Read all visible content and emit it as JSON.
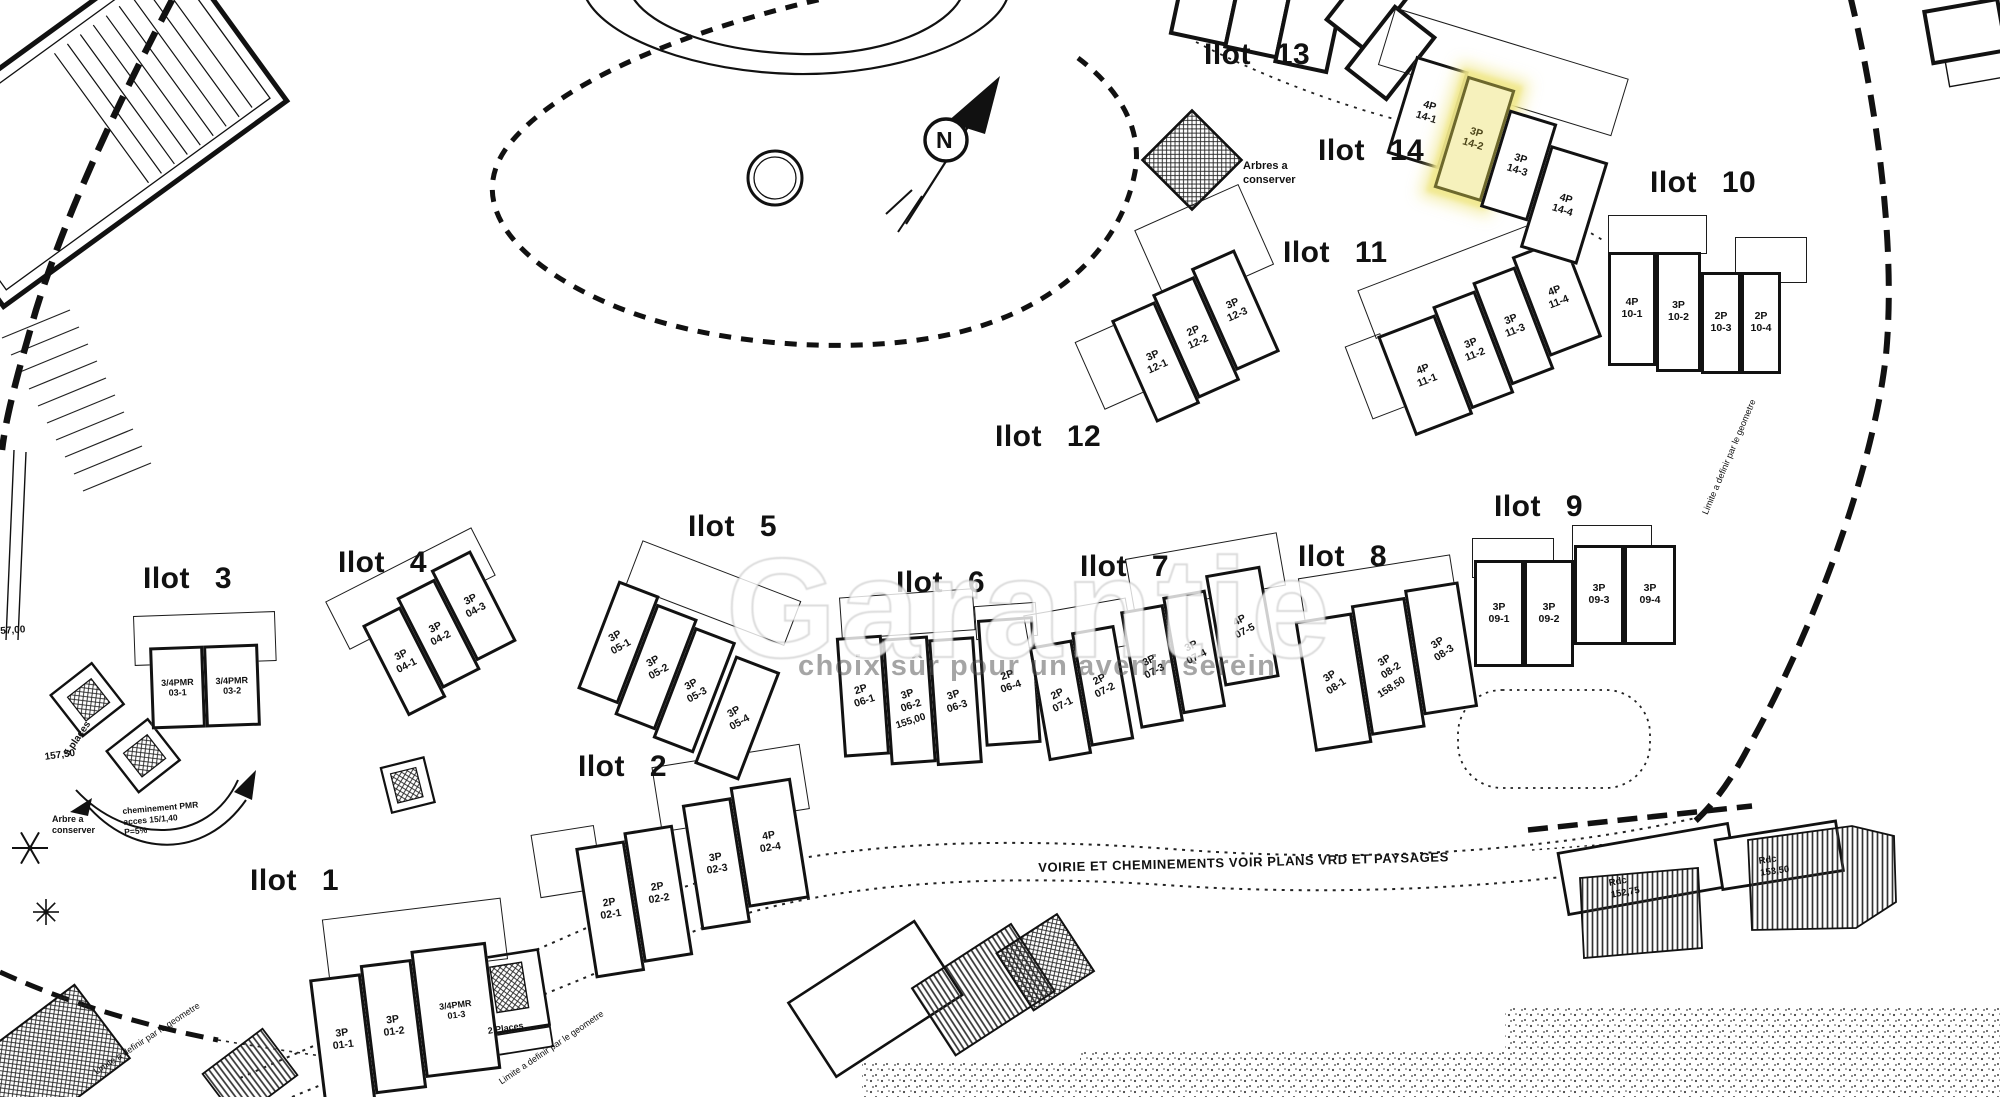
{
  "plan": {
    "ilots": [
      {
        "id": "1",
        "label": "Ilot 1",
        "units": [
          {
            "type": "3P",
            "num": "01-1"
          },
          {
            "type": "3P",
            "num": "01-2"
          },
          {
            "type": "3/4PMR",
            "num": "01-3"
          }
        ]
      },
      {
        "id": "2",
        "label": "Ilot 2",
        "units": [
          {
            "type": "2P",
            "num": "02-1"
          },
          {
            "type": "2P",
            "num": "02-2"
          },
          {
            "type": "3P",
            "num": "02-3"
          },
          {
            "type": "4P",
            "num": "02-4"
          }
        ]
      },
      {
        "id": "3",
        "label": "Ilot 3",
        "units": [
          {
            "type": "3/4PMR",
            "num": "03-1"
          },
          {
            "type": "3/4PMR",
            "num": "03-2"
          }
        ]
      },
      {
        "id": "4",
        "label": "Ilot 4",
        "units": [
          {
            "type": "3P",
            "num": "04-1"
          },
          {
            "type": "3P",
            "num": "04-2"
          },
          {
            "type": "3P",
            "num": "04-3"
          }
        ]
      },
      {
        "id": "5",
        "label": "Ilot 5",
        "units": [
          {
            "type": "3P",
            "num": "05-1"
          },
          {
            "type": "3P",
            "num": "05-2"
          },
          {
            "type": "3P",
            "num": "05-3"
          },
          {
            "type": "3P",
            "num": "05-4"
          }
        ]
      },
      {
        "id": "6",
        "label": "Ilot 6",
        "units": [
          {
            "type": "2P",
            "num": "06-1"
          },
          {
            "type": "3P",
            "num": "06-2",
            "note": "155,00"
          },
          {
            "type": "3P",
            "num": "06-3"
          },
          {
            "type": "2P",
            "num": "06-4"
          }
        ]
      },
      {
        "id": "7",
        "label": "Ilot 7",
        "units": [
          {
            "type": "2P",
            "num": "07-1"
          },
          {
            "type": "2P",
            "num": "07-2"
          },
          {
            "type": "3P",
            "num": "07-3"
          },
          {
            "type": "3P",
            "num": "07-4"
          },
          {
            "type": "4P",
            "num": "07-5"
          }
        ]
      },
      {
        "id": "8",
        "label": "Ilot 8",
        "units": [
          {
            "type": "3P",
            "num": "08-1"
          },
          {
            "type": "3P",
            "num": "08-2",
            "note": "158,50"
          },
          {
            "type": "3P",
            "num": "08-3"
          }
        ]
      },
      {
        "id": "9",
        "label": "Ilot 9",
        "units": [
          {
            "type": "3P",
            "num": "09-1"
          },
          {
            "type": "3P",
            "num": "09-2"
          },
          {
            "type": "3P",
            "num": "09-3"
          },
          {
            "type": "3P",
            "num": "09-4"
          }
        ]
      },
      {
        "id": "10",
        "label": "Ilot 10",
        "units": [
          {
            "type": "4P",
            "num": "10-1"
          },
          {
            "type": "3P",
            "num": "10-2"
          },
          {
            "type": "2P",
            "num": "10-3"
          },
          {
            "type": "2P",
            "num": "10-4"
          }
        ]
      },
      {
        "id": "11",
        "label": "Ilot 11",
        "units": [
          {
            "type": "4P",
            "num": "11-1"
          },
          {
            "type": "3P",
            "num": "11-2"
          },
          {
            "type": "3P",
            "num": "11-3"
          },
          {
            "type": "4P",
            "num": "11-4"
          }
        ]
      },
      {
        "id": "12",
        "label": "Ilot 12",
        "units": [
          {
            "type": "3P",
            "num": "12-1"
          },
          {
            "type": "2P",
            "num": "12-2"
          },
          {
            "type": "3P",
            "num": "12-3"
          }
        ]
      },
      {
        "id": "13",
        "label": "Ilot 13",
        "units": []
      },
      {
        "id": "14",
        "label": "Ilot 14",
        "units": [
          {
            "type": "4P",
            "num": "14-1"
          },
          {
            "type": "3P",
            "num": "14-2",
            "highlighted": true
          },
          {
            "type": "3P",
            "num": "14-3"
          },
          {
            "type": "4P",
            "num": "14-4"
          }
        ]
      }
    ],
    "selection": {
      "ilot": "Ilot 14",
      "unit_type": "3P",
      "unit_num": "14-2",
      "highlight_fill": "#f6f1bc",
      "highlight_stroke": "#6d682c"
    },
    "annotations": {
      "arbres_tr": "Arbres a\nconserver",
      "arbre_bl": "Arbre a\nconserver",
      "pmr_path": "cheminement PMR\nacces 15/1,40\nP=5%",
      "cote_left_top": "57,00",
      "cote_left_bottom": "157,50",
      "places_5": "5 places",
      "places_2": "2 Places",
      "voirie": "VOIRIE ET CHEMINEMENTS VOIR PLANS VRD ET PAYSAGES",
      "limite_geometre": "Limite a definir par le geometre",
      "rdc_152": "Rdc\n152,75",
      "rdc_153": "Rdc\n153,50",
      "north": "N"
    },
    "watermark": {
      "big_text": "Garantie",
      "tagline": "choix sûr pour un avenir serein"
    },
    "colors": {
      "ink": "#111111",
      "paper": "#ffffff",
      "highlight": "#f6f1bc"
    }
  }
}
